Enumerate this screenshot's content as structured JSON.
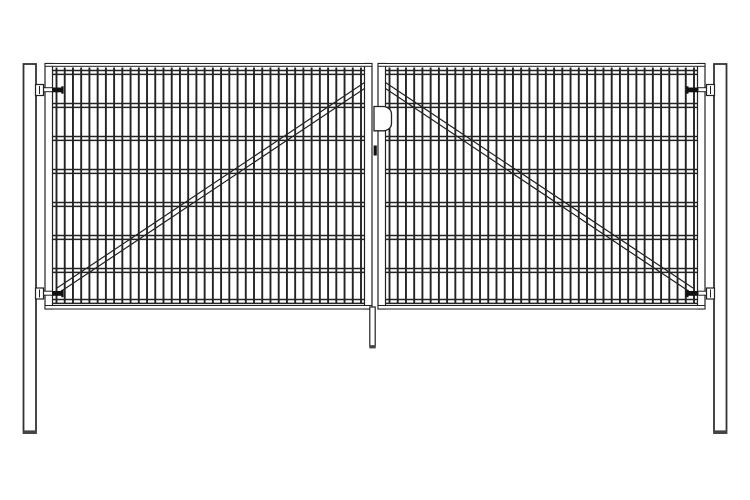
{
  "drawing": {
    "title_semantic": "double-leaf-mesh-gate-technical-drawing",
    "canvas": {
      "width": 750,
      "height": 500,
      "background": "#ffffff"
    },
    "palette": {
      "line": "#222222",
      "wire": "#232323",
      "post_line": "#333333",
      "hardware_dark": "#111111",
      "cap_dark": "#444444",
      "fill_white": "#ffffff"
    },
    "posts": {
      "left": {
        "x": 23.5,
        "y": 64,
        "w": 12.5,
        "h": 369
      },
      "right": {
        "x": 714.0,
        "y": 64,
        "w": 12.5,
        "h": 369
      },
      "stroke_w": 1.8,
      "base_cap_h": 2.6
    },
    "gate": {
      "frame": {
        "y_top": 63.5,
        "y_bottom": 309,
        "tube_w": 7.5,
        "top_rail_h": 2.8,
        "bottom_rail_y": 305.5,
        "bottom_rail_h": 3.5
      },
      "leaves": {
        "left": {
          "x_outer": 45,
          "x_inner": 372
        },
        "right": {
          "x_inner": 378,
          "x_outer": 705
        }
      },
      "mesh": {
        "vertical": {
          "count": 38,
          "y1": 67.5,
          "y2": 303,
          "w": 1.9
        },
        "left_span": {
          "x1": 56.5,
          "x2": 361.0
        },
        "right_span": {
          "x1": 389.5,
          "x2": 694.0
        },
        "horizontal_pairs_y": [
          70.5,
          103.5,
          136.5,
          169.5,
          202.5,
          235.5,
          268.5,
          299.5
        ],
        "pair_gap": 3.9,
        "h_stroke_w": 1.5
      },
      "braces": {
        "stroke_w": 1.2,
        "left": [
          [
            57,
            288,
            366,
            81.5
          ],
          [
            57,
            294,
            366,
            87.5
          ]
        ],
        "right": [
          [
            384,
            81.5,
            693,
            288
          ],
          [
            384,
            87.5,
            693,
            294
          ]
        ]
      },
      "hinges": {
        "rows_y": [
          84.5,
          288
        ],
        "bracket": {
          "w": 8,
          "h": 11
        },
        "arm": {
          "w": 9,
          "h": 4,
          "dy": 3.2
        },
        "strap": {
          "w": 11.5,
          "h": 4.8,
          "dy": 3
        },
        "tick": {
          "w": 2.2,
          "h": 7.4,
          "dy": 1.8
        },
        "left_bracket_x": 35.5,
        "left_arm_x": 43.5,
        "left_strap_x": 52,
        "right_strap_x": 686.5,
        "right_arm_x": 698,
        "right_bracket_x": 706.5
      },
      "latch": {
        "x": 374,
        "y_top": 106.5,
        "y_bottom": 130.8,
        "x_flat_end": 384,
        "x_bulge": 391.5,
        "y_bulge_top": 114.5,
        "y_bulge_bottom": 123,
        "pin": {
          "x": 373.6,
          "y": 145.5,
          "w": 3.2,
          "h": 10
        }
      },
      "drop_rod": {
        "x": 369.8,
        "y": 307,
        "w": 5.4,
        "h": 39,
        "cap": {
          "x": 369.3,
          "y": 345.2,
          "w": 6.4,
          "h": 3.2
        }
      }
    }
  }
}
